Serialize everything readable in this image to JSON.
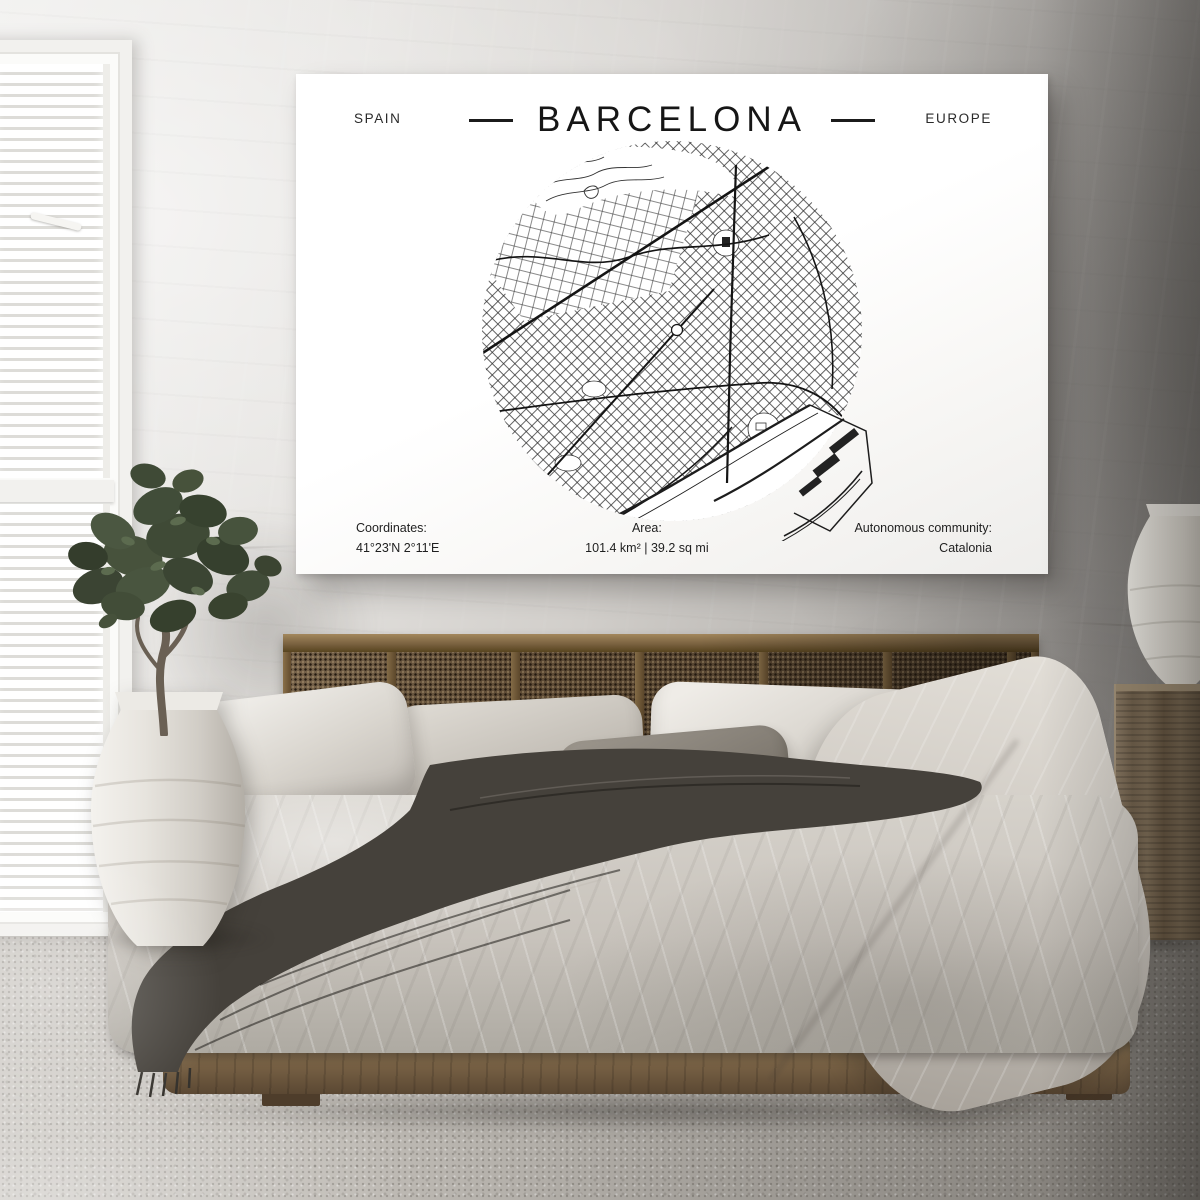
{
  "poster": {
    "country": "SPAIN",
    "title": "BARCELONA",
    "continent": "EUROPE",
    "map_icon": "circular-street-map-of-barcelona",
    "footer": {
      "coordinates_label": "Coordinates:",
      "coordinates_value": "41°23'N 2°11'E",
      "area_label": "Area:",
      "area_value": "101.4 km² | 39.2 sq mi",
      "community_label": "Autonomous community:",
      "community_value": "Catalonia"
    },
    "colors": {
      "paper": "#ffffff",
      "ink": "#1c1c1c"
    }
  },
  "room": {
    "colors": {
      "wall": "#b8b5b0",
      "wall_shadow": "#8a8885",
      "carpet": "#b3afa9",
      "bed_wood": "#6f5838",
      "cane_headboard": "#5f4c36",
      "duvet": "#ccc7c0",
      "throw_blanket": "#45413b",
      "plant_foliage": "#3f4a36",
      "ceramic": "#e9e6e0"
    }
  }
}
